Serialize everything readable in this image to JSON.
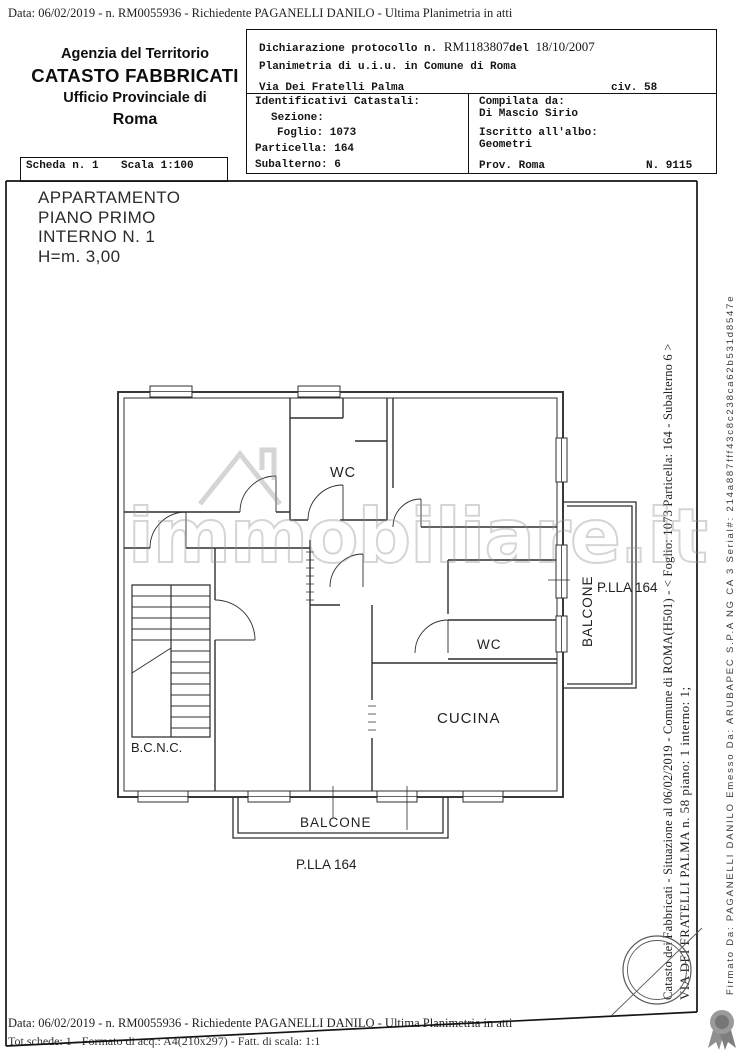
{
  "header_top": {
    "line": "Data: 06/02/2019 -  n. RM0055936 - Richiedente PAGANELLI DANILO - Ultima Planimetria in atti"
  },
  "agency": {
    "line1": "Agenzia del Territorio",
    "line2": "CATASTO FABBRICATI",
    "line3": "Ufficio Provinciale di",
    "line4": "Roma"
  },
  "declaration": {
    "protocol_label": "Dichiarazione protocollo n.",
    "protocol_number": "RM1183807",
    "del_label": "del",
    "protocol_date": "18/10/2007",
    "planimetria_line": "Planimetria di u.i.u. in Comune di Roma",
    "street": "Via Dei Fratelli Palma",
    "civ": "civ. 58",
    "identificativi": {
      "title": "Identificativi Catastali:",
      "sezione": "Sezione:",
      "foglio": "Foglio: 1073",
      "particella": "Particella: 164",
      "subalterno": "Subalterno: 6"
    },
    "compilata": {
      "title": "Compilata da:",
      "name": "Di Mascio Sirio",
      "albo_label": "Iscritto all'albo:",
      "albo": "Geometri",
      "prov": "Prov. Roma",
      "num": "N. 9115"
    }
  },
  "scheda": {
    "scheda": "Scheda n. 1",
    "scala": "Scala 1:100"
  },
  "plan": {
    "title_lines": [
      "APPARTAMENTO",
      "PIANO PRIMO",
      "INTERNO N. 1",
      "H=m. 3,00"
    ],
    "rooms": {
      "wc_top": "WC",
      "wc_mid": "WC",
      "cucina": "CUCINA",
      "bcnc": "B.C.N.C.",
      "balcone_bottom": "BALCONE",
      "balcone_right": "BALCONE",
      "plla_bottom": "P.LLA 164",
      "plla_right": "P.LLA 164"
    }
  },
  "watermark": {
    "text": "immobiliare.it",
    "color": "#919191"
  },
  "side_texts": {
    "catasto": "Catasto dei Fabbricati - Situazione al 06/02/2019 - Comune di ROMA(H501) - < Foglio: 1073 Particella: 164 - Subalterno 6 >",
    "via": "VIA DEI FRATELLI PALMA n. 58 piano: 1 interno: 1;",
    "firmato": "Firmato Da: PAGANELLI DANILO Emesso Da: ARUBAPEC S.P.A NG CA 3 Serial#: 214a887fff43c8c238ca62b531d8547e"
  },
  "footer": {
    "line1": "Data: 06/02/2019 -  n. RM0055936 - Richiedente PAGANELLI DANILO - Ultima Planimetria in atti",
    "line2": "Tot.schede: 1 - Formato di acq.: A4(210x297) - Fatt. di scala: 1:1"
  },
  "icons": {
    "watermark_house": "house-outline-icon",
    "stamp": "circle-stamp-icon",
    "seal": "rosette-ribbon-icon"
  }
}
